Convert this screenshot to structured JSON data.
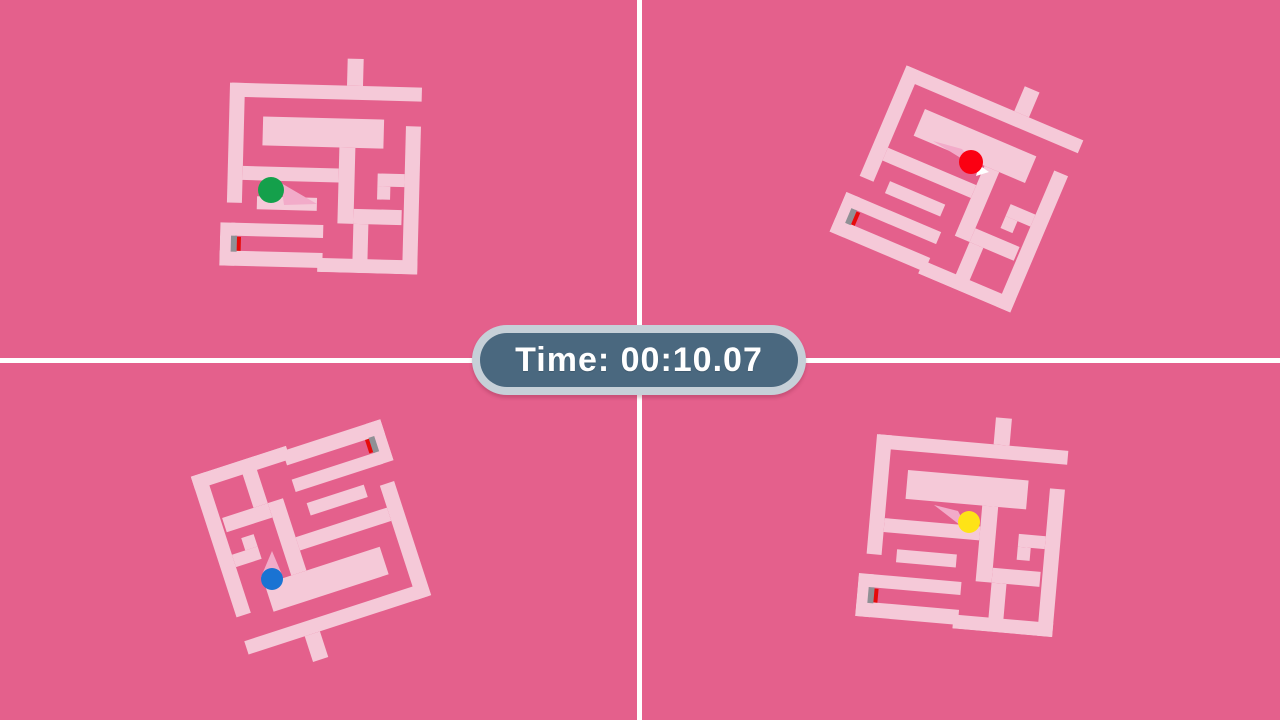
{
  "timer": {
    "text": "Time: 00:10.07"
  },
  "palette": {
    "background": "#e4608c",
    "maze_wall": "#f5c9d8",
    "ball_trail": "#f2abc9",
    "divider": "#ffffff",
    "start_marker_gray": "#909095",
    "start_marker_red": "#e60b0b",
    "timer_outer": "#c6d0d8",
    "timer_inner": "#4a687f",
    "timer_text": "#ffffff"
  },
  "quadrants": [
    {
      "id": "top-left",
      "player": "green",
      "maze_style": "left:222px;top:52px;transform:rotate(1.5deg)",
      "ball": {
        "color": "#14a04b",
        "x": "271",
        "y": "190",
        "r": "13"
      },
      "trail_points": "281,183 284,205 317,204"
    },
    {
      "id": "top-right",
      "player": "red",
      "maze_style": "left:863px;top:63px;transform:rotate(23deg)",
      "ball": {
        "color": "#fb0012",
        "x": "971",
        "y": "162",
        "r": "12"
      },
      "trail_points": "933,141 962,149 977,168",
      "trail_tip_points": "979,165 989,172 976,176"
    },
    {
      "id": "bottom-left",
      "player": "blue",
      "maze_style": "left:218px;top:441px;transform:rotate(162deg)",
      "ball": {
        "color": "#1a73d3",
        "x": "272",
        "y": "579",
        "r": "11"
      },
      "trail_points": "272,551 261,577 283,577"
    },
    {
      "id": "bottom-right",
      "player": "yellow",
      "maze_style": "left:864px;top:409px;transform:rotate(5deg)",
      "ball": {
        "color": "#fee317",
        "x": "969",
        "y": "522",
        "r": "11"
      },
      "trail_points": "934,505 958,511 969,532"
    }
  ]
}
